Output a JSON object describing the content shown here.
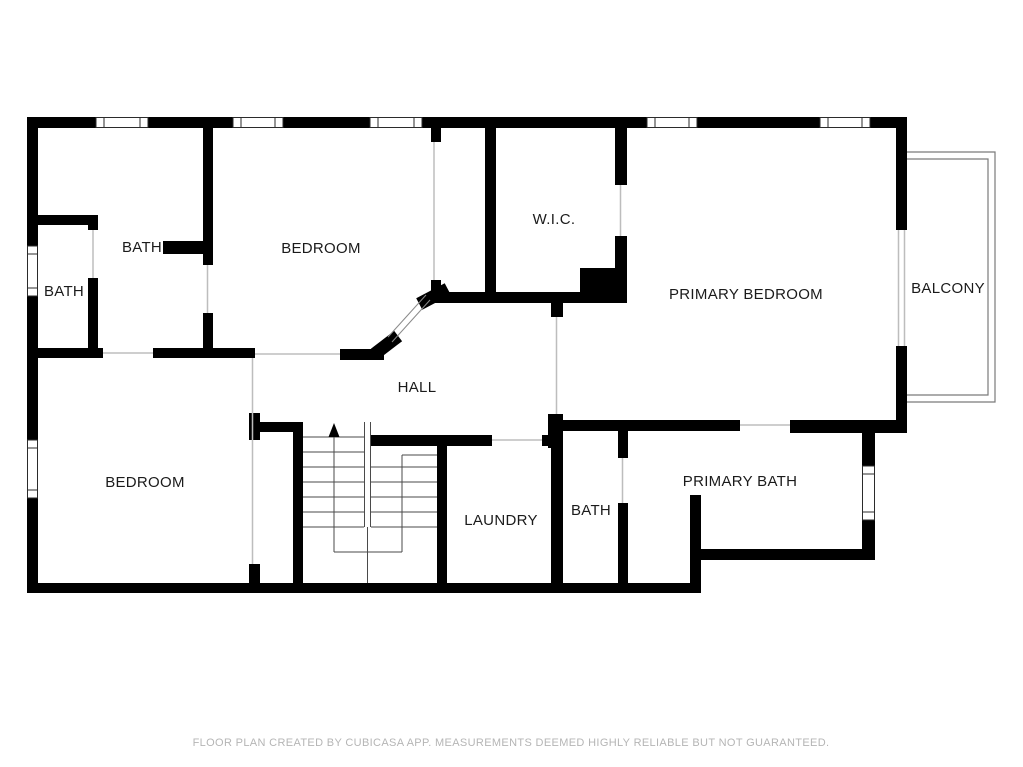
{
  "rooms": {
    "bath_small": "BATH",
    "bath_upper": "BATH",
    "bedroom_upper": "BEDROOM",
    "wic": "W.I.C.",
    "primary_bedroom": "PRIMARY BEDROOM",
    "balcony": "BALCONY",
    "hall": "HALL",
    "bedroom_lower": "BEDROOM",
    "laundry": "LAUNDRY",
    "bath_lower": "BATH",
    "primary_bath": "PRIMARY BATH"
  },
  "footer": {
    "disclaimer": "FLOOR PLAN CREATED BY CUBICASA APP. MEASUREMENTS DEEMED HIGHLY RELIABLE BUT NOT GUARANTEED."
  },
  "colors": {
    "wall": "#000000",
    "label": "#1b1b1b",
    "footer_text": "#b5b5b5",
    "background": "#ffffff"
  }
}
